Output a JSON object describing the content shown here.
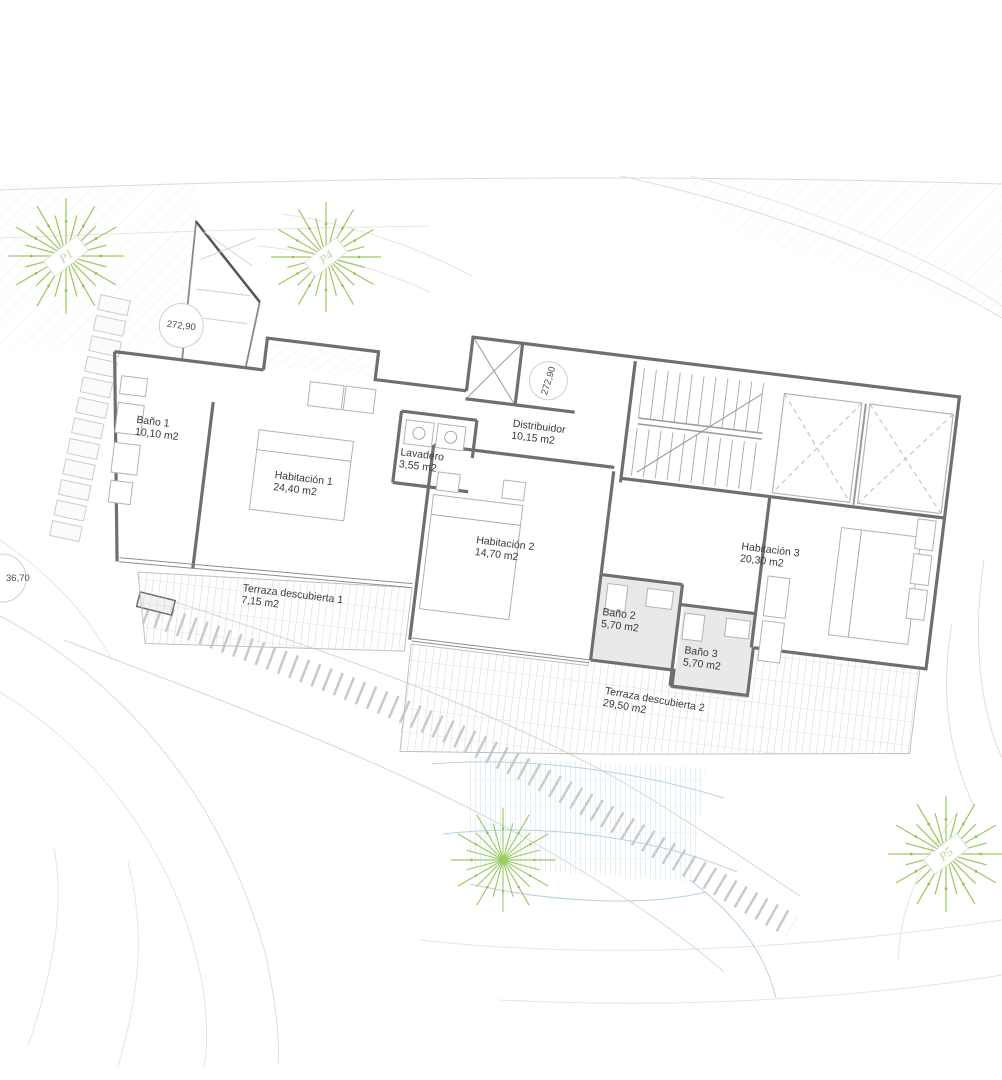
{
  "rooms": [
    {
      "label": "Baño 1",
      "area": "10,10 m2"
    },
    {
      "label": "Habitación 1",
      "area": "24,40 m2"
    },
    {
      "label": "Lavadero",
      "area": "3,55 m2"
    },
    {
      "label": "Distribuidor",
      "area": "10,15 m2"
    },
    {
      "label": "Habitación 2",
      "area": "14,70 m2"
    },
    {
      "label": "Baño 2",
      "area": "5,70 m2"
    },
    {
      "label": "Baño 3",
      "area": "5,70 m2"
    },
    {
      "label": "Habitación 3",
      "area": "20,30 m2"
    },
    {
      "label": "Terraza descubierta 1",
      "area": "7,15 m2"
    },
    {
      "label": "Terraza descubierta 2",
      "area": "29,50 m2"
    }
  ],
  "levels": [
    {
      "value": "272,90"
    },
    {
      "value": "272,90"
    },
    {
      "value": "36,70"
    }
  ],
  "trees": [
    {
      "label": "P1"
    },
    {
      "label": "P4"
    },
    {
      "label": "P5"
    }
  ],
  "colors": {
    "wall": "#6f6f6f",
    "tree_green": "#9bcb63",
    "pool_blue": "#c6dee8",
    "label_text": "#3a3a3a",
    "deck_line": "#c9c9c9"
  }
}
